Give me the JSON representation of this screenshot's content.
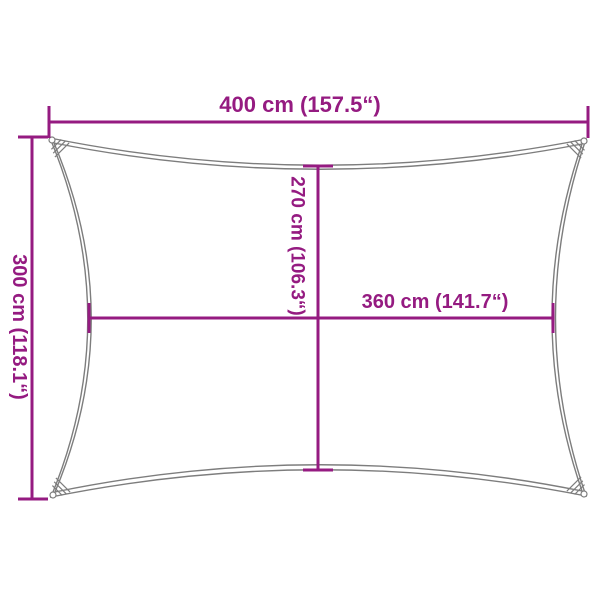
{
  "diagram": {
    "type": "product-dimension-diagram",
    "subject": "rectangular shade sail outline with concave edges",
    "dimensions": {
      "outer_width": {
        "label": "400 cm (157.5“)"
      },
      "outer_height": {
        "label": "300 cm (118.1“)"
      },
      "inner_height": {
        "label": "270 cm (106.3“)"
      },
      "inner_width": {
        "label": "360 cm (141.7“)"
      }
    },
    "colors": {
      "dimension": "#951b81",
      "outline": "#7d7d7d",
      "background": "#ffffff"
    }
  }
}
